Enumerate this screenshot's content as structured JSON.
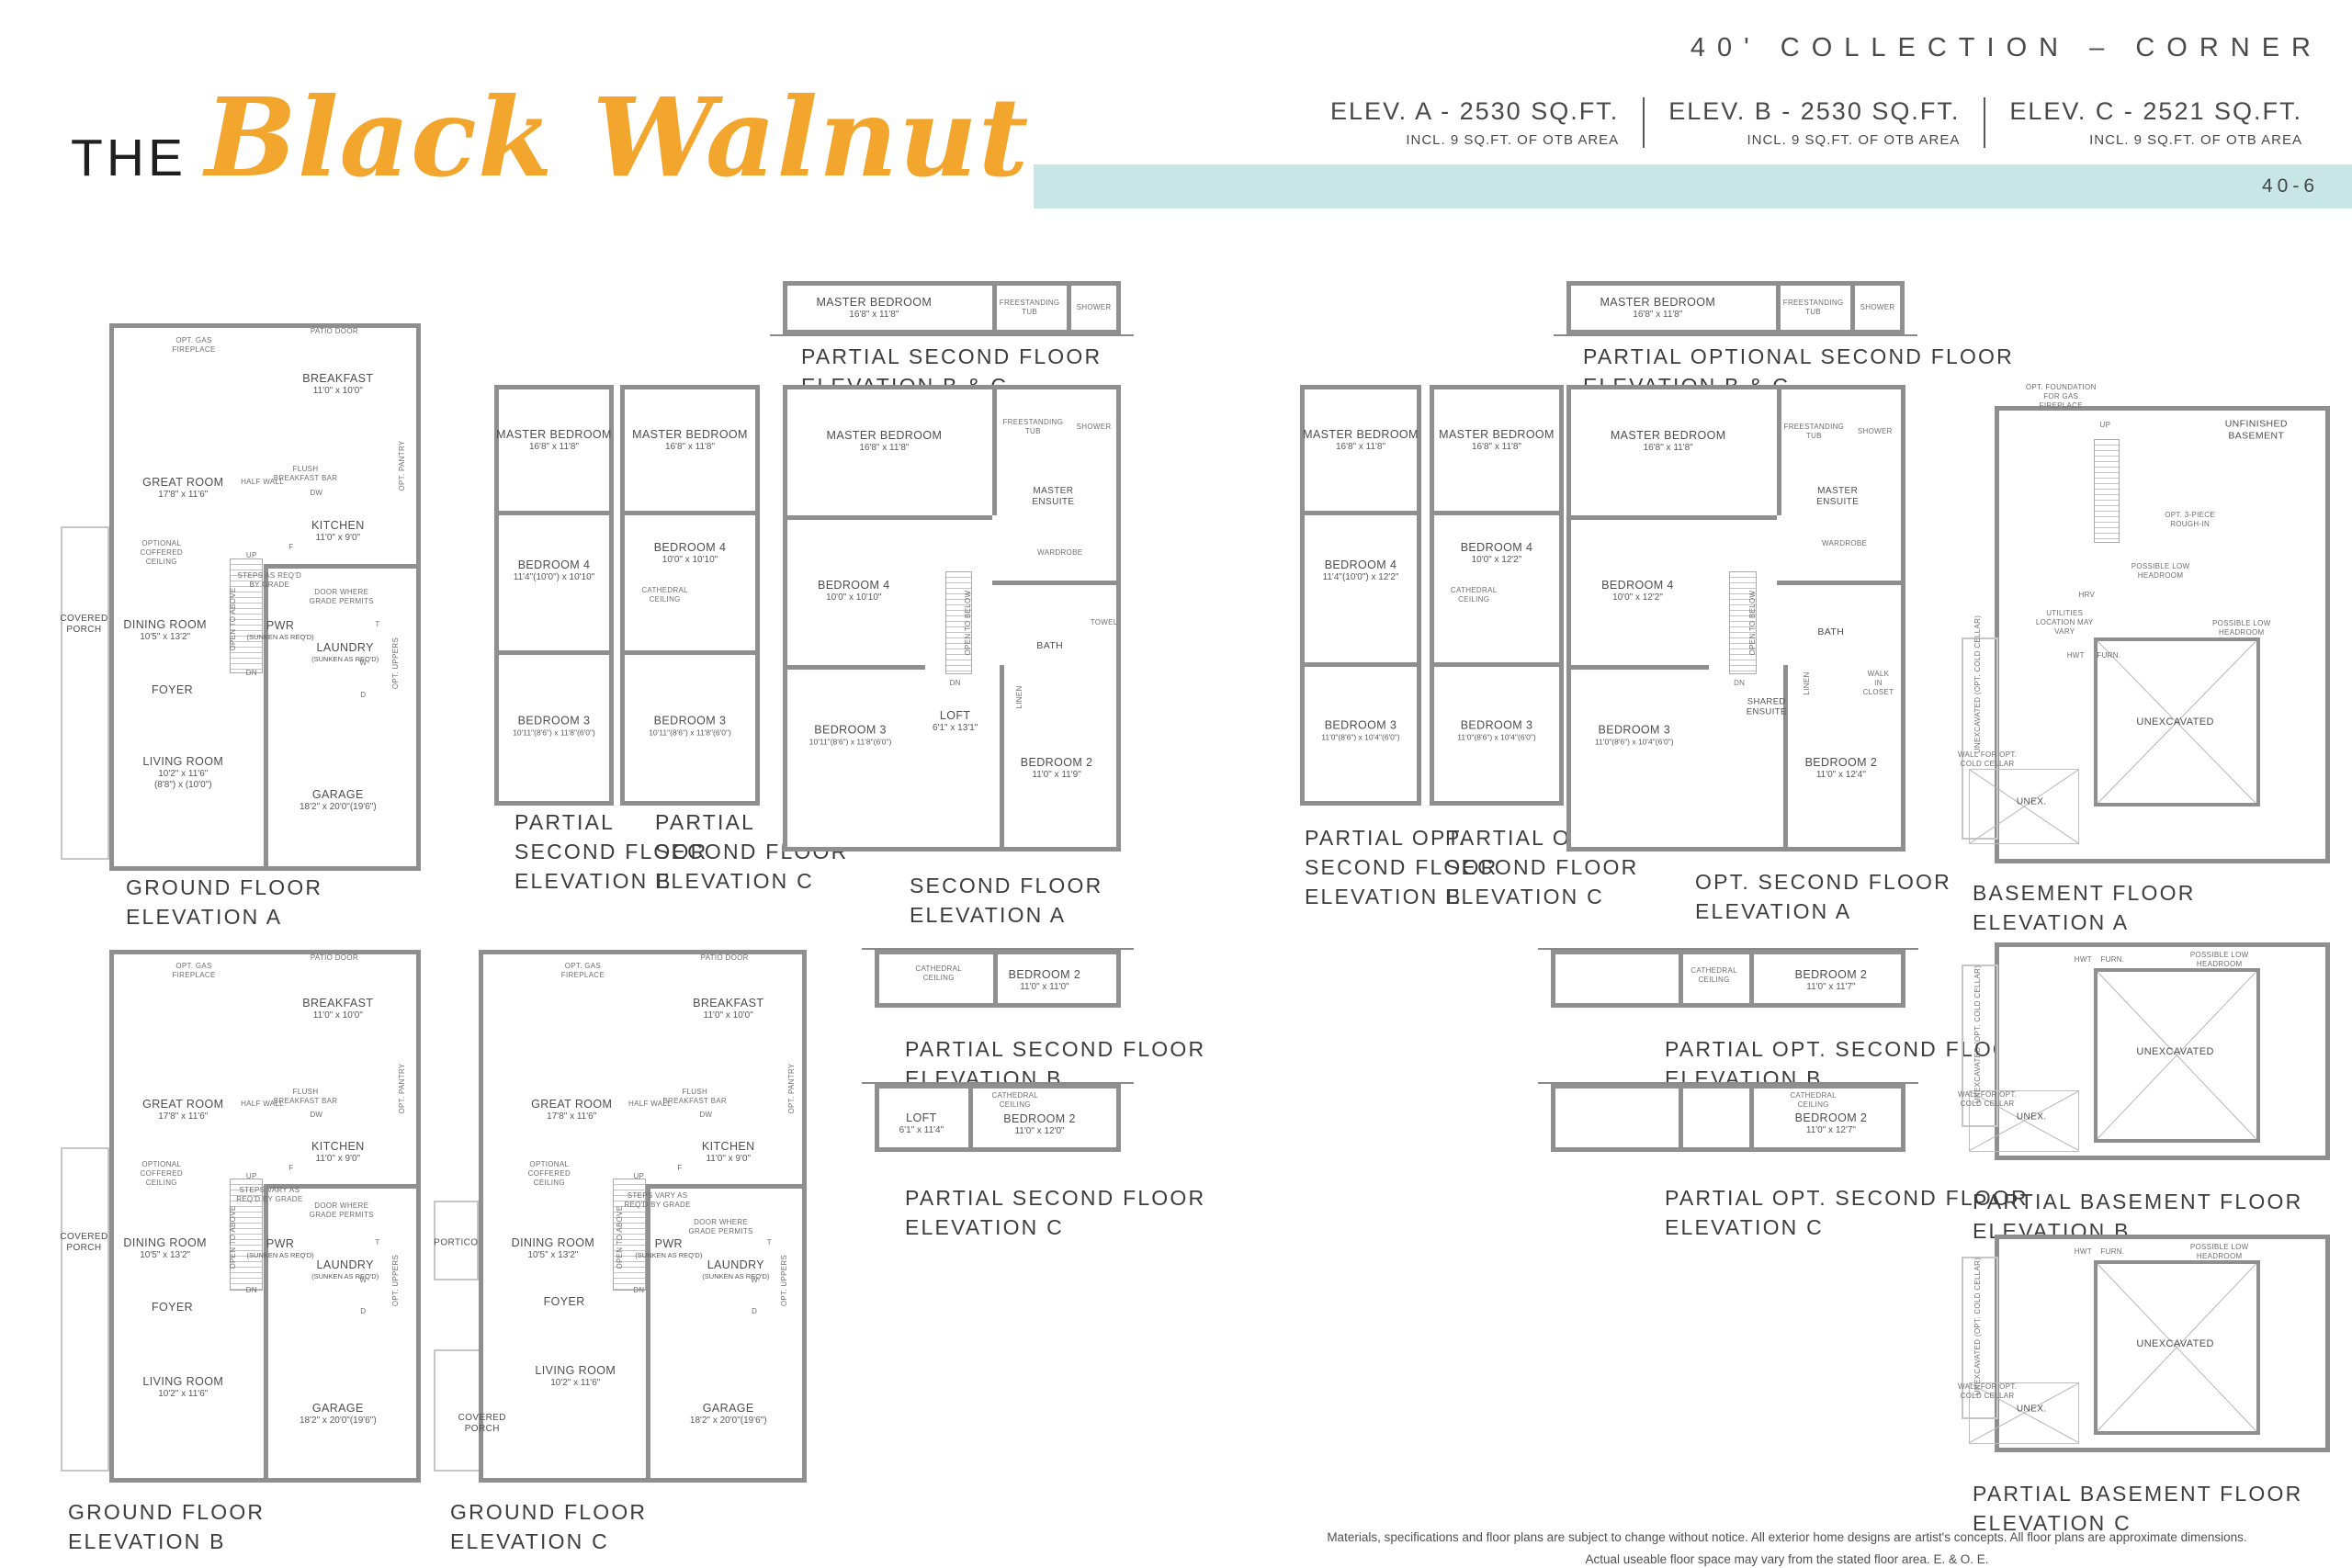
{
  "header": {
    "collection": "40' COLLECTION – CORNER",
    "page_code": "40-6",
    "title_prefix": "THE",
    "title_script": "Black Walnut",
    "elevations": [
      {
        "name": "ELEV. A - 2530 SQ.FT.",
        "note": "INCL. 9 SQ.FT. OF OTB AREA"
      },
      {
        "name": "ELEV. B - 2530 SQ.FT.",
        "note": "INCL. 9 SQ.FT. OF OTB AREA"
      },
      {
        "name": "ELEV. C - 2521 SQ.FT.",
        "note": "INCL. 9 SQ.FT. OF OTB AREA"
      }
    ],
    "colors": {
      "accent": "#f3a62e",
      "band": "#c9e6e7",
      "wall": "#8f8f8f"
    }
  },
  "footer": {
    "line1": "Materials, specifications and floor plans are subject to change without notice. All exterior home designs are artist's concepts. All floor plans are approximate dimensions.",
    "line2": "Actual useable floor space may vary from the stated floor area. E. & O. E."
  },
  "plans": {
    "ground_a": {
      "caption": [
        "GROUND FLOOR",
        "ELEVATION A"
      ],
      "rooms": [
        {
          "name": "BREAKFAST",
          "dims": "11'0\" x 10'0\""
        },
        {
          "name": "GREAT ROOM",
          "dims": "17'8\" x 11'6\""
        },
        {
          "name": "KITCHEN",
          "dims": "11'0\" x 9'0\""
        },
        {
          "name": "DINING ROOM",
          "dims": "10'5\" x 13'2\""
        },
        {
          "name": "PWR",
          "dims": "(SUNKEN AS REQ'D)"
        },
        {
          "name": "LAUNDRY",
          "dims": "(SUNKEN AS REQ'D)"
        },
        {
          "name": "FOYER"
        },
        {
          "name": "COVERED PORCH"
        },
        {
          "name": "LIVING ROOM",
          "dims": "10'2\" x 11'6\"",
          "dims2": "(8'8\") x (10'0\")"
        },
        {
          "name": "GARAGE",
          "dims": "18'2\" x 20'0\"(19'6\")"
        }
      ],
      "notes": [
        "OPT. GAS FIREPLACE",
        "PATIO DOOR",
        "HALF WALL",
        "FLUSH BREAKFAST BAR",
        "OPT. PANTRY",
        "OPTIONAL COFFERED CEILING",
        "OPT. UPPERS",
        "DOOR WHERE GRADE PERMITS",
        "STEPS AS REQ'D BY GRADE",
        "OPEN TO ABOVE",
        "UP",
        "DN",
        "DW",
        "F",
        "W",
        "D",
        "T"
      ]
    },
    "ground_b": {
      "caption": [
        "GROUND FLOOR",
        "ELEVATION B"
      ],
      "rooms": [
        {
          "name": "BREAKFAST",
          "dims": "11'0\" x 10'0\""
        },
        {
          "name": "GREAT ROOM",
          "dims": "17'8\" x 11'6\""
        },
        {
          "name": "KITCHEN",
          "dims": "11'0\" x 9'0\""
        },
        {
          "name": "DINING ROOM",
          "dims": "10'5\" x 13'2\""
        },
        {
          "name": "PWR",
          "dims": "(SUNKEN AS REQ'D)"
        },
        {
          "name": "LAUNDRY",
          "dims": "(SUNKEN AS REQ'D)"
        },
        {
          "name": "FOYER"
        },
        {
          "name": "COVERED PORCH"
        },
        {
          "name": "LIVING ROOM",
          "dims": "10'2\" x 11'6\""
        },
        {
          "name": "GARAGE",
          "dims": "18'2\" x 20'0\"(19'6\")"
        }
      ],
      "notes": [
        "OPT. GAS FIREPLACE",
        "PATIO DOOR",
        "HALF WALL",
        "FLUSH BREAKFAST BAR",
        "OPT. PANTRY",
        "OPTIONAL COFFERED CEILING",
        "OPT. UPPERS",
        "DOOR WHERE GRADE PERMITS",
        "STEPS VARY AS REQ'D BY GRADE",
        "OPEN TO ABOVE",
        "UP",
        "DN",
        "DW",
        "F",
        "W",
        "D",
        "T"
      ]
    },
    "ground_c": {
      "caption": [
        "GROUND FLOOR",
        "ELEVATION C"
      ],
      "rooms": [
        {
          "name": "BREAKFAST",
          "dims": "11'0\" x 10'0\""
        },
        {
          "name": "GREAT ROOM",
          "dims": "17'8\" x 11'6\""
        },
        {
          "name": "KITCHEN",
          "dims": "11'0\" x 9'0\""
        },
        {
          "name": "DINING ROOM",
          "dims": "10'5\" x 13'2\""
        },
        {
          "name": "PWR",
          "dims": "(SUNKEN AS REQ'D)"
        },
        {
          "name": "LAUNDRY",
          "dims": "(SUNKEN AS REQ'D)"
        },
        {
          "name": "FOYER"
        },
        {
          "name": "PORTICO"
        },
        {
          "name": "LIVING ROOM",
          "dims": "10'2\" x 11'6\""
        },
        {
          "name": "COVERED PORCH"
        },
        {
          "name": "GARAGE",
          "dims": "18'2\" x 20'0\"(19'6\")"
        }
      ],
      "notes": [
        "OPT. GAS FIREPLACE",
        "PATIO DOOR",
        "HALF WALL",
        "FLUSH BREAKFAST BAR",
        "OPT. PANTRY",
        "OPTIONAL COFFERED CEILING",
        "OPT. UPPERS",
        "DOOR WHERE GRADE PERMITS",
        "STEPS VARY AS REQ'D BY GRADE",
        "OPEN TO ABOVE",
        "UP",
        "DN",
        "DW",
        "F",
        "W",
        "D",
        "T"
      ]
    },
    "p2bc": {
      "caption": [
        "PARTIAL SECOND FLOOR",
        "ELEVATION B & C"
      ],
      "rooms": [
        {
          "name": "MASTER BEDROOM",
          "dims": "16'8\" x 11'8\""
        }
      ],
      "notes": [
        "FREESTANDING TUB",
        "SHOWER"
      ]
    },
    "p2b": {
      "caption": [
        "PARTIAL",
        "SECOND FLOOR",
        "ELEVATION B"
      ],
      "rooms": [
        {
          "name": "MASTER BEDROOM",
          "dims": "16'8\" x 11'8\""
        },
        {
          "name": "BEDROOM 4",
          "dims": "11'4\"(10'0\") x 10'10\""
        },
        {
          "name": "BEDROOM 3",
          "dims": "10'11\"(8'6\") x 11'8\"(6'0\")"
        }
      ],
      "notes": []
    },
    "p2c": {
      "caption": [
        "PARTIAL",
        "SECOND FLOOR",
        "ELEVATION C"
      ],
      "rooms": [
        {
          "name": "MASTER BEDROOM",
          "dims": "16'8\" x 11'8\""
        },
        {
          "name": "BEDROOM 4",
          "dims": "10'0\" x 10'10\""
        },
        {
          "name": "BEDROOM 3",
          "dims": "10'11\"(8'6\") x 11'8\"(6'0\")"
        }
      ],
      "notes": [
        "CATHEDRAL CEILING"
      ]
    },
    "second_a": {
      "caption": [
        "SECOND FLOOR",
        "ELEVATION A"
      ],
      "rooms": [
        {
          "name": "MASTER BEDROOM",
          "dims": "16'8\" x 11'8\""
        },
        {
          "name": "BEDROOM 4",
          "dims": "10'0\" x 10'10\""
        },
        {
          "name": "BEDROOM 3",
          "dims": "10'11\"(8'6\") x 11'8\"(6'0\")"
        },
        {
          "name": "LOFT",
          "dims": "6'1\" x 13'1\""
        },
        {
          "name": "BEDROOM 2",
          "dims": "11'0\" x 11'9\""
        },
        {
          "name": "MASTER ENSUITE"
        },
        {
          "name": "BATH"
        }
      ],
      "notes": [
        "FREESTANDING TUB",
        "SHOWER",
        "WARDROBE",
        "TOWEL",
        "LINEN",
        "OPEN TO BELOW",
        "DN"
      ]
    },
    "po2bc": {
      "caption": [
        "PARTIAL OPTIONAL SECOND FLOOR",
        "ELEVATION B & C"
      ],
      "rooms": [
        {
          "name": "MASTER BEDROOM",
          "dims": "16'8\" x 11'8\""
        }
      ],
      "notes": [
        "FREESTANDING TUB",
        "SHOWER"
      ]
    },
    "po2b": {
      "caption": [
        "PARTIAL OPT.",
        "SECOND FLOOR",
        "ELEVATION B"
      ],
      "rooms": [
        {
          "name": "MASTER BEDROOM",
          "dims": "16'8\" x 11'8\""
        },
        {
          "name": "BEDROOM 4",
          "dims": "11'4\"(10'0\") x 12'2\""
        },
        {
          "name": "BEDROOM 3",
          "dims": "11'0\"(8'6\") x 10'4\"(6'0\")"
        }
      ],
      "notes": []
    },
    "po2c": {
      "caption": [
        "PARTIAL OPT.",
        "SECOND FLOOR",
        "ELEVATION C"
      ],
      "rooms": [
        {
          "name": "MASTER BEDROOM",
          "dims": "16'8\" x 11'8\""
        },
        {
          "name": "BEDROOM 4",
          "dims": "10'0\" x 12'2\""
        },
        {
          "name": "BEDROOM 3",
          "dims": "11'0\"(8'6\") x 10'4\"(6'0\")"
        }
      ],
      "notes": [
        "CATHEDRAL CEILING"
      ]
    },
    "opt2a": {
      "caption": [
        "OPT. SECOND FLOOR",
        "ELEVATION A"
      ],
      "rooms": [
        {
          "name": "MASTER BEDROOM",
          "dims": "16'8\" x 11'8\""
        },
        {
          "name": "BEDROOM 4",
          "dims": "10'0\" x 12'2\""
        },
        {
          "name": "BEDROOM 3",
          "dims": "11'0\"(8'6\") x 10'4\"(6'0\")"
        },
        {
          "name": "BEDROOM 2",
          "dims": "11'0\" x 12'4\""
        },
        {
          "name": "MASTER ENSUITE"
        },
        {
          "name": "SHARED ENSUITE"
        },
        {
          "name": "BATH"
        }
      ],
      "notes": [
        "FREESTANDING TUB",
        "SHOWER",
        "WARDROBE",
        "WALK IN CLOSET",
        "LINEN",
        "OPEN TO BELOW",
        "DN"
      ]
    },
    "base_a": {
      "caption": [
        "BASEMENT FLOOR",
        "ELEVATION A"
      ],
      "rooms": [
        {
          "name": "UNFINISHED BASEMENT"
        },
        {
          "name": "UNEXCAVATED"
        },
        {
          "name": "UNEX."
        }
      ],
      "notes": [
        "OPT. FOUNDATION FOR GAS FIREPLACE",
        "OPT. 3-PIECE ROUGH-IN",
        "POSSIBLE LOW HEADROOM",
        "POSSIBLE LOW HEADROOM",
        "UTILITIES LOCATION MAY VARY",
        "HRV",
        "HWT",
        "FURN.",
        "UNEXCAVATED (OPT. COLD CELLAR)",
        "WALL FOR OPT. COLD CELLAR",
        "UP"
      ]
    },
    "p2bs": {
      "caption": [
        "PARTIAL SECOND FLOOR",
        "ELEVATION B"
      ],
      "rooms": [
        {
          "name": "BEDROOM 2",
          "dims": "11'0\" x 11'0\""
        }
      ],
      "notes": [
        "CATHEDRAL CEILING"
      ]
    },
    "p2cs": {
      "caption": [
        "PARTIAL SECOND FLOOR",
        "ELEVATION C"
      ],
      "rooms": [
        {
          "name": "LOFT",
          "dims": "6'1\" x 11'4\""
        },
        {
          "name": "BEDROOM 2",
          "dims": "11'0\" x 12'0\""
        }
      ],
      "notes": [
        "CATHEDRAL CEILING"
      ]
    },
    "po2bs": {
      "caption": [
        "PARTIAL OPT. SECOND FLOOR",
        "ELEVATION B"
      ],
      "rooms": [
        {
          "name": "BEDROOM 2",
          "dims": "11'0\" x 11'7\""
        }
      ],
      "notes": [
        "CATHEDRAL CEILING"
      ]
    },
    "po2cs": {
      "caption": [
        "PARTIAL OPT. SECOND FLOOR",
        "ELEVATION C"
      ],
      "rooms": [
        {
          "name": "BEDROOM 2",
          "dims": "11'0\" x 12'7\""
        }
      ],
      "notes": [
        "CATHEDRAL CEILING"
      ]
    },
    "pbb": {
      "caption": [
        "PARTIAL BASEMENT FLOOR",
        "ELEVATION B"
      ],
      "rooms": [
        {
          "name": "UNEXCAVATED"
        },
        {
          "name": "UNEX."
        }
      ],
      "notes": [
        "HWT",
        "FURN.",
        "POSSIBLE LOW HEADROOM",
        "UNEXCAVATED (OPT. COLD CELLAR)",
        "WALL FOR OPT. COLD CELLAR"
      ]
    },
    "pbc": {
      "caption": [
        "PARTIAL BASEMENT FLOOR",
        "ELEVATION C"
      ],
      "rooms": [
        {
          "name": "UNEXCAVATED"
        },
        {
          "name": "UNEX."
        }
      ],
      "notes": [
        "HWT",
        "FURN.",
        "POSSIBLE LOW HEADROOM",
        "UNEXCAVATED (OPT. COLD CELLAR)",
        "WALL FOR OPT. COLD CELLAR"
      ]
    }
  }
}
